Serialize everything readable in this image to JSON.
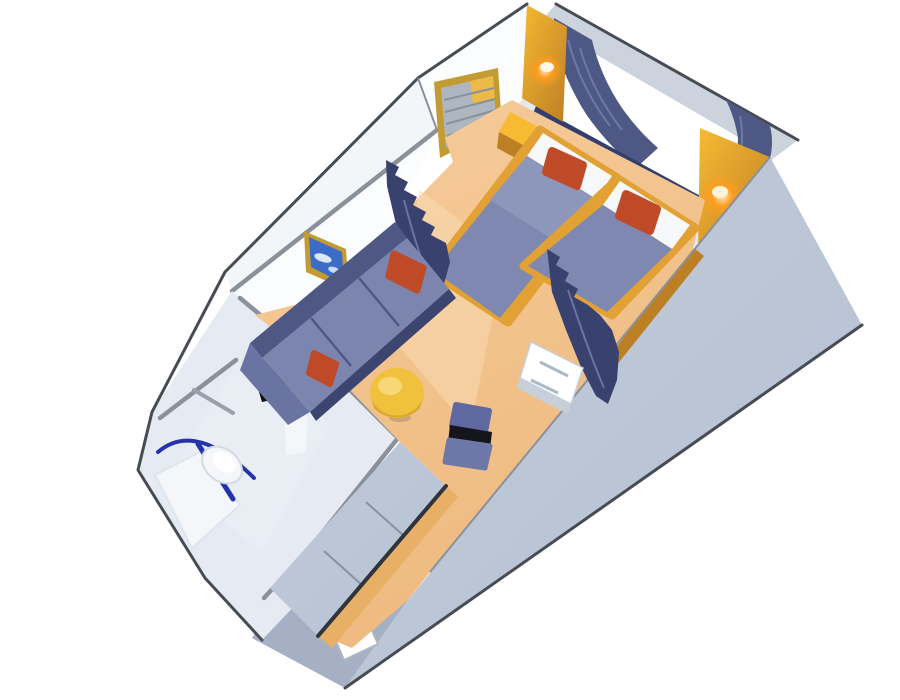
{
  "image": {
    "title": "Cruise ship stateroom 3D floor plan",
    "type": "isometric cutaway rendering of an oceanview cabin",
    "background": "#ffffff"
  },
  "colors": {
    "background": "#ffffff",
    "floor": "#f2c28c",
    "floorLight": "#f8dab3",
    "wallWhite": "#fbfcfe",
    "wallShade": "#e6ebf3",
    "wallOuter": "#f3f6f9",
    "wallEdge": "#474c54",
    "grayEdge": "#8a919b",
    "valance": "#ccd3dd",
    "windowRim": "#e4e9f0",
    "windowWhite": "#ffffff",
    "curtain": "#4d5885",
    "curtainDark": "#39426e",
    "curtainFold": "#7681ab",
    "navySill": "#333e6d",
    "gold": "#e2a135",
    "goldDark": "#bd7f24",
    "goldBright": "#f7bb33",
    "lampGlow": "#ff9d1e",
    "lampCore": "#ffeccb",
    "bedSpread": "#7e88b0",
    "bedSpreadLight": "#8d97bc",
    "pillow": "#f7f8fa",
    "cushionRed": "#bf4a28",
    "sofaBack": "#4f5885",
    "sofaSeat": "#7b85ae",
    "sofaArm": "#6a74a2",
    "sofaShadow": "#3c4470",
    "band": "#b7c2d4",
    "bandDark": "#a5b0c4",
    "closetPanel": "#bfc9d8",
    "rail": "#30353c",
    "tableYellow": "#f0c13d",
    "tableShadow": "#d9a82e",
    "chairBlue": "#5f69a0",
    "chairSeat": "#6e78a8",
    "chairDark": "#15151c",
    "white": "#ffffff",
    "counterBlack": "#0e0e10",
    "fixtureWhite": "#f4f6f9",
    "fixtureShadow": "#c7d0da",
    "showerRail": "#2433a9",
    "artBlue": "#3a6cc8",
    "frameGold": "#c29b33",
    "doorWhite": "#ffffff"
  },
  "rooms": [
    {
      "name": "sleeping-area",
      "items": [
        "twin-bed-left",
        "twin-bed-right",
        "red-throw-pillows",
        "nightstand",
        "wall-mirror",
        "wall-lamp-left",
        "wall-lamp-right",
        "picture-window",
        "window-curtains",
        "valance",
        "divider-curtain-left",
        "divider-curtain-right"
      ]
    },
    {
      "name": "sitting-area",
      "items": [
        "sofa",
        "sofa-red-pillows",
        "round-coffee-table",
        "desk-chair",
        "drawer-unit",
        "wall-picture"
      ]
    },
    {
      "name": "bathroom",
      "items": [
        "vanity-counter",
        "pedestal-sink",
        "faucet",
        "toilet",
        "shower-tray",
        "shower-curtain-rail",
        "towel-bar"
      ]
    },
    {
      "name": "entryway",
      "items": [
        "entrance-door",
        "closet-sliding-doors",
        "closet-rail"
      ]
    }
  ]
}
